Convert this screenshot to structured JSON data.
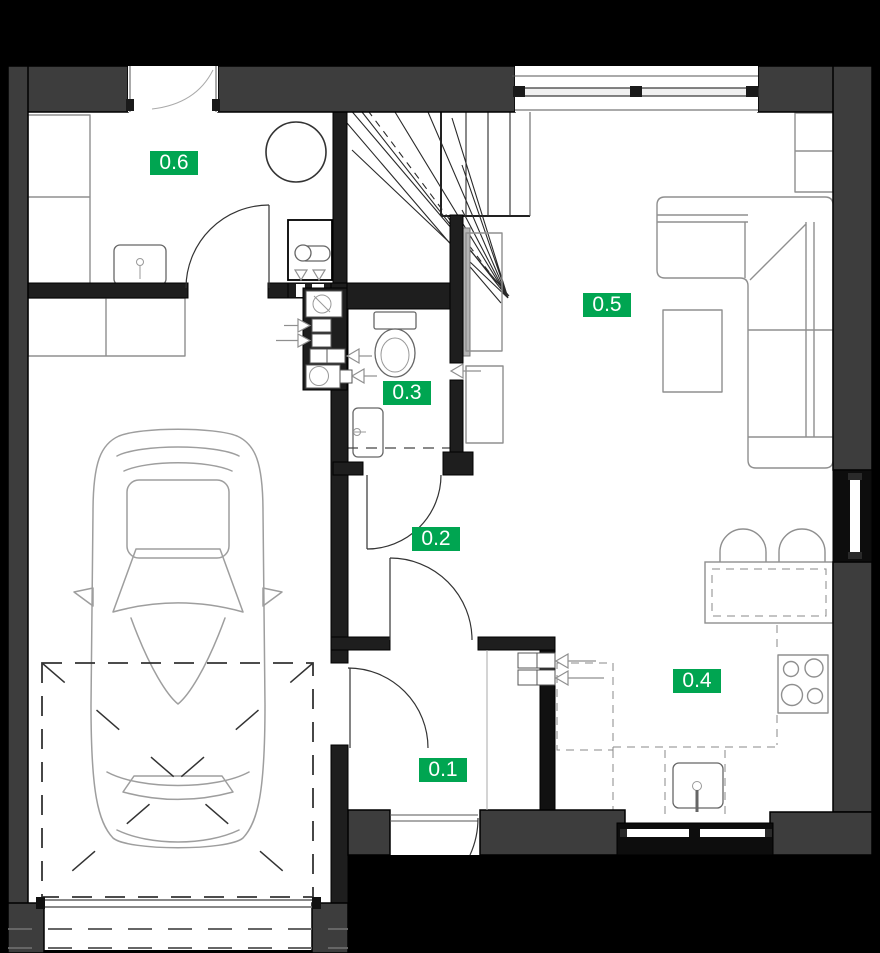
{
  "plan": {
    "kind": "architectural-floor-plan",
    "floor_shown": "ground floor with garage, hall, wc, kitchen and living room"
  },
  "colors": {
    "background": "#000000",
    "floor": "#FFFFFF",
    "outer_wall": "#3D3D3D",
    "inner_wall": "#1E1E1E",
    "black_wall": "#0D0D0D",
    "furniture_line": "#8F8F8F",
    "fixture_line": "#666666",
    "car_line": "#9E9E9E",
    "stair_line": "#2A2A2A",
    "label_bg": "#00A551",
    "label_text": "#FFFFFF"
  },
  "rooms": {
    "r01": {
      "label": "0.1"
    },
    "r02": {
      "label": "0.2"
    },
    "r03": {
      "label": "0.3"
    },
    "r04": {
      "label": "0.4"
    },
    "r05": {
      "label": "0.5"
    },
    "r06": {
      "label": "0.6"
    }
  },
  "objects": [
    "car-top-view",
    "winder-staircase",
    "corner-sofa",
    "coffee-table",
    "tv-and-cabinet",
    "toilet",
    "wc-washbasin",
    "utility-sink",
    "washing-machine",
    "wardrobe-cabinets",
    "kitchen-bar-counter",
    "bar-stools",
    "cooktop",
    "kitchen-sink",
    "tall-kitchen-unit",
    "ventilation-arrows",
    "duct-shaft",
    "garage-door",
    "entrance-door",
    "window-band",
    "side-window",
    "garage-maneuver-zone"
  ]
}
